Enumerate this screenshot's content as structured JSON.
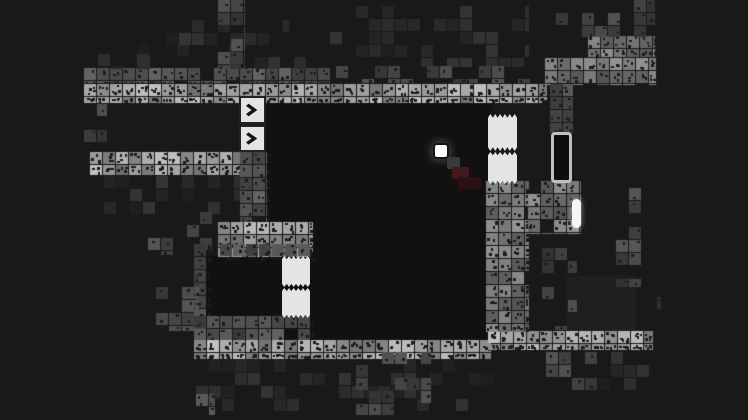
{
  "scene": {
    "width": 748,
    "height": 420,
    "tile_size": 13,
    "colors": {
      "background": "#191919",
      "room_fill": "#111111",
      "room_fill_light": "#1f1f1f",
      "tile_bright": "#989898",
      "tile_mid": "#757575",
      "tile_dim": "#4f4f4f",
      "tile_scatter_dim": "#454545",
      "tile_dark": "#2a2a2a",
      "dot": "#1c1c1c",
      "block_white": "#e4e4e4",
      "chevron_glyph": "#111111",
      "door_outline": "#c0c0c0",
      "door_fill": "#0d0d0d",
      "pill_white": "#f6f6f6",
      "player_white": "#ffffff",
      "trail_gray": "#3a3a3a",
      "trail_maroon": "#44191d",
      "trail_maroon_dark": "#2c1114"
    },
    "structures": [
      {
        "name": "main-room-fill",
        "type": "fill",
        "color": "room_fill",
        "x": 266,
        "y": 100,
        "w": 226,
        "h": 242
      },
      {
        "name": "lower-left-room-fill",
        "type": "fill",
        "color": "room_fill",
        "x": 206,
        "y": 256,
        "w": 78,
        "h": 62
      },
      {
        "name": "lower-right-room-fill",
        "type": "fill",
        "color": "room_fill_light",
        "x": 566,
        "y": 276,
        "w": 70,
        "h": 58
      },
      {
        "name": "top-bar-upper-row",
        "type": "dim",
        "x": 84,
        "y": 68,
        "w": 248,
        "h": 16
      },
      {
        "name": "top-bar",
        "type": "bright",
        "x": 84,
        "y": 84,
        "w": 464,
        "h": 20
      },
      {
        "name": "top-left-pyramid-row1",
        "type": "scatter-dark",
        "x": 138,
        "y": 44,
        "w": 184,
        "h": 26
      },
      {
        "name": "top-left-pyramid-row2",
        "type": "scatter-dark",
        "x": 166,
        "y": 20,
        "w": 124,
        "h": 26
      },
      {
        "name": "top-left-spine",
        "type": "scatter-dim",
        "x": 218,
        "y": 0,
        "w": 28,
        "h": 70
      },
      {
        "name": "top-left-ledge",
        "type": "scatter-dark",
        "x": 98,
        "y": 54,
        "w": 56,
        "h": 16
      },
      {
        "name": "top-mid-scatter",
        "type": "scatter-dark",
        "x": 330,
        "y": 6,
        "w": 200,
        "h": 62
      },
      {
        "name": "top-mid-underrow",
        "type": "scatter-dim",
        "x": 336,
        "y": 66,
        "w": 212,
        "h": 18
      },
      {
        "name": "left-spine",
        "type": "scatter-dim",
        "x": 84,
        "y": 104,
        "w": 24,
        "h": 50
      },
      {
        "name": "left-bar",
        "type": "bright",
        "x": 90,
        "y": 152,
        "w": 158,
        "h": 24
      },
      {
        "name": "below-left-bar-scatter",
        "type": "scatter-dark",
        "x": 104,
        "y": 176,
        "w": 140,
        "h": 40
      },
      {
        "name": "left-mid-scatter",
        "type": "scatter-dim",
        "x": 148,
        "y": 212,
        "w": 72,
        "h": 44
      },
      {
        "name": "chevron-column",
        "type": "dim",
        "x": 240,
        "y": 152,
        "w": 28,
        "h": 72
      },
      {
        "name": "mid-cluster",
        "type": "bright",
        "x": 218,
        "y": 222,
        "w": 96,
        "h": 36
      },
      {
        "name": "lowerleft-room-top-wall",
        "type": "dim",
        "x": 194,
        "y": 244,
        "w": 118,
        "h": 14
      },
      {
        "name": "lowerleft-room-left-wall",
        "type": "dim",
        "x": 194,
        "y": 244,
        "w": 14,
        "h": 88
      },
      {
        "name": "lowerleft-room-bottom-wall",
        "type": "dim",
        "x": 194,
        "y": 316,
        "w": 118,
        "h": 26
      },
      {
        "name": "left-vert-strip",
        "type": "scatter-dim",
        "x": 156,
        "y": 274,
        "w": 44,
        "h": 58
      },
      {
        "name": "bottom-bar-left",
        "type": "bright",
        "x": 194,
        "y": 340,
        "w": 298,
        "h": 20
      },
      {
        "name": "bottom-bar-right",
        "type": "bright",
        "x": 488,
        "y": 331,
        "w": 166,
        "h": 20
      },
      {
        "name": "right-wall-column",
        "type": "mid",
        "x": 486,
        "y": 181,
        "w": 44,
        "h": 152
      },
      {
        "name": "door-cluster",
        "type": "mid",
        "x": 528,
        "y": 181,
        "w": 54,
        "h": 54
      },
      {
        "name": "right-mid-column",
        "type": "scatter-dim",
        "x": 542,
        "y": 235,
        "w": 36,
        "h": 96
      },
      {
        "name": "top-right-bar",
        "type": "mid",
        "x": 545,
        "y": 58,
        "w": 112,
        "h": 28
      },
      {
        "name": "top-right-upper-row",
        "type": "mid",
        "x": 588,
        "y": 36,
        "w": 68,
        "h": 22
      },
      {
        "name": "top-right-scatter",
        "type": "scatter-dim",
        "x": 556,
        "y": 0,
        "w": 100,
        "h": 38
      },
      {
        "name": "top-right-spine",
        "type": "dim",
        "x": 550,
        "y": 84,
        "w": 24,
        "h": 50
      },
      {
        "name": "right-room-right-wall",
        "type": "scatter-dim",
        "x": 616,
        "y": 188,
        "w": 26,
        "h": 100
      },
      {
        "name": "right-room-far-tile",
        "type": "scatter-dim",
        "x": 644,
        "y": 284,
        "w": 18,
        "h": 30
      },
      {
        "name": "bottom-scatter-wide",
        "type": "scatter-dark",
        "x": 196,
        "y": 360,
        "w": 300,
        "h": 52
      },
      {
        "name": "bottom-mid-cluster",
        "type": "scatter-dim",
        "x": 356,
        "y": 352,
        "w": 76,
        "h": 64
      },
      {
        "name": "bottom-isolated-tile",
        "type": "dim",
        "x": 196,
        "y": 394,
        "w": 20,
        "h": 22
      },
      {
        "name": "bottom-right-column",
        "type": "scatter-dim",
        "x": 546,
        "y": 352,
        "w": 52,
        "h": 66
      },
      {
        "name": "bottom-right-scatter",
        "type": "scatter-dark",
        "x": 598,
        "y": 352,
        "w": 56,
        "h": 50
      }
    ],
    "sprites": [
      {
        "name": "conveyor-chevron-block-1",
        "type": "chevron",
        "x": 239,
        "y": 96,
        "w": 27,
        "h": 28
      },
      {
        "name": "conveyor-chevron-block-2",
        "type": "chevron",
        "x": 239,
        "y": 125,
        "w": 27,
        "h": 27
      },
      {
        "name": "white-gate-right-upper-block",
        "type": "gate",
        "x": 488,
        "y": 114,
        "w": 29,
        "h": 37
      },
      {
        "name": "white-gate-right-lower-block",
        "type": "gate",
        "x": 488,
        "y": 152,
        "w": 29,
        "h": 32
      },
      {
        "name": "white-gate-left-upper-block",
        "type": "gate",
        "x": 282,
        "y": 256,
        "w": 28,
        "h": 31
      },
      {
        "name": "white-gate-left-lower-block",
        "type": "gate",
        "x": 282,
        "y": 288,
        "w": 28,
        "h": 30
      },
      {
        "name": "door-capsule",
        "type": "door",
        "x": 551,
        "y": 132,
        "w": 21,
        "h": 51
      },
      {
        "name": "white-pill",
        "type": "pill",
        "x": 572,
        "y": 199,
        "w": 9,
        "h": 29
      },
      {
        "name": "player-square",
        "type": "player",
        "x": 433,
        "y": 143,
        "w": 16,
        "h": 16
      },
      {
        "name": "player-trail-segment-1",
        "type": "trail",
        "color": "trail_gray",
        "x": 447,
        "y": 157,
        "w": 13,
        "h": 12
      },
      {
        "name": "player-trail-segment-2",
        "type": "trail",
        "color": "trail_maroon",
        "x": 452,
        "y": 167,
        "w": 17,
        "h": 12
      },
      {
        "name": "player-trail-segment-3",
        "type": "trail",
        "color": "trail_maroon_dark",
        "x": 458,
        "y": 177,
        "w": 23,
        "h": 12
      }
    ]
  }
}
